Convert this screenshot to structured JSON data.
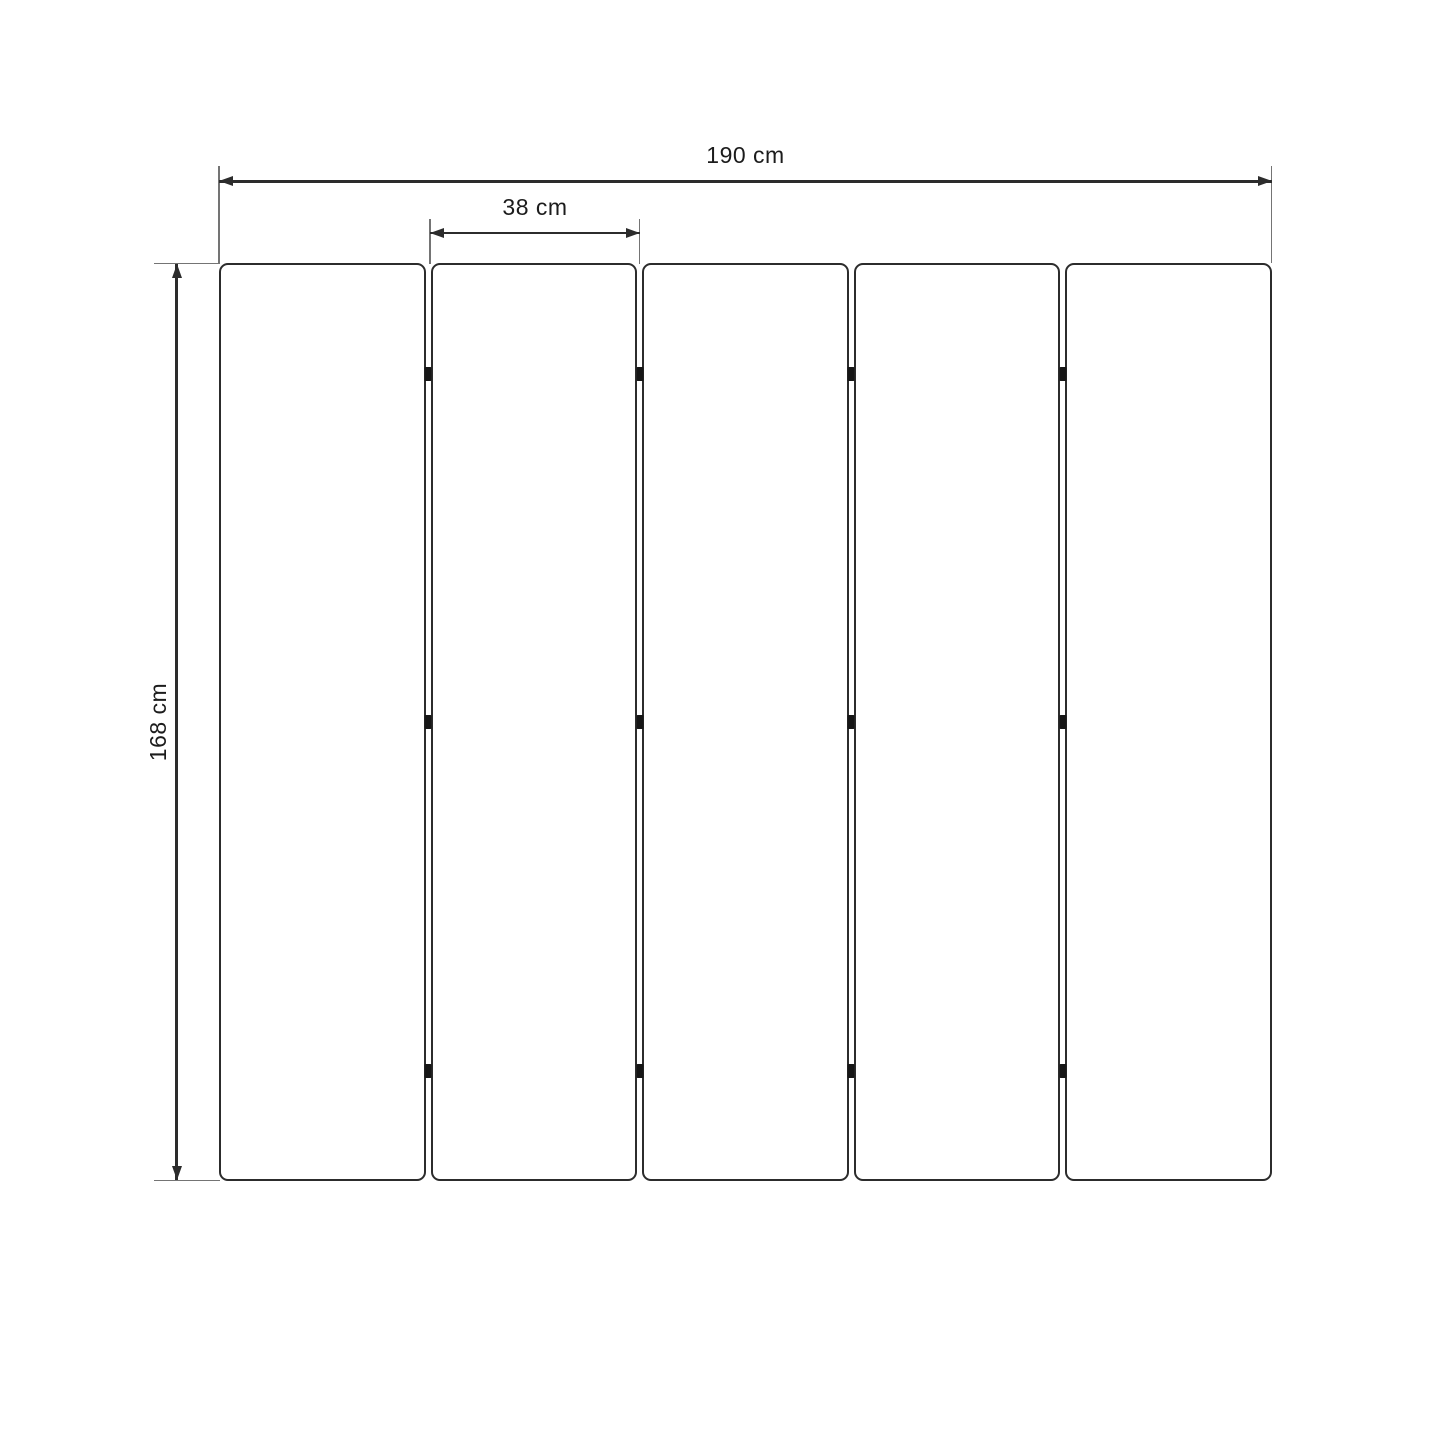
{
  "diagram": {
    "type": "product-dimension-drawing",
    "subject": "five-panel folding screen (front view)",
    "labels": {
      "total_width": "190 cm",
      "panel_width": "38 cm",
      "height": "168 cm"
    },
    "panels": {
      "count": 5
    },
    "hinges": {
      "columns": 4,
      "rows": 3
    },
    "colors": {
      "line": "#2c2c2c",
      "extension": "#747474",
      "hinge": "#161616",
      "text": "#1c1c1c",
      "background": "#ffffff"
    }
  }
}
